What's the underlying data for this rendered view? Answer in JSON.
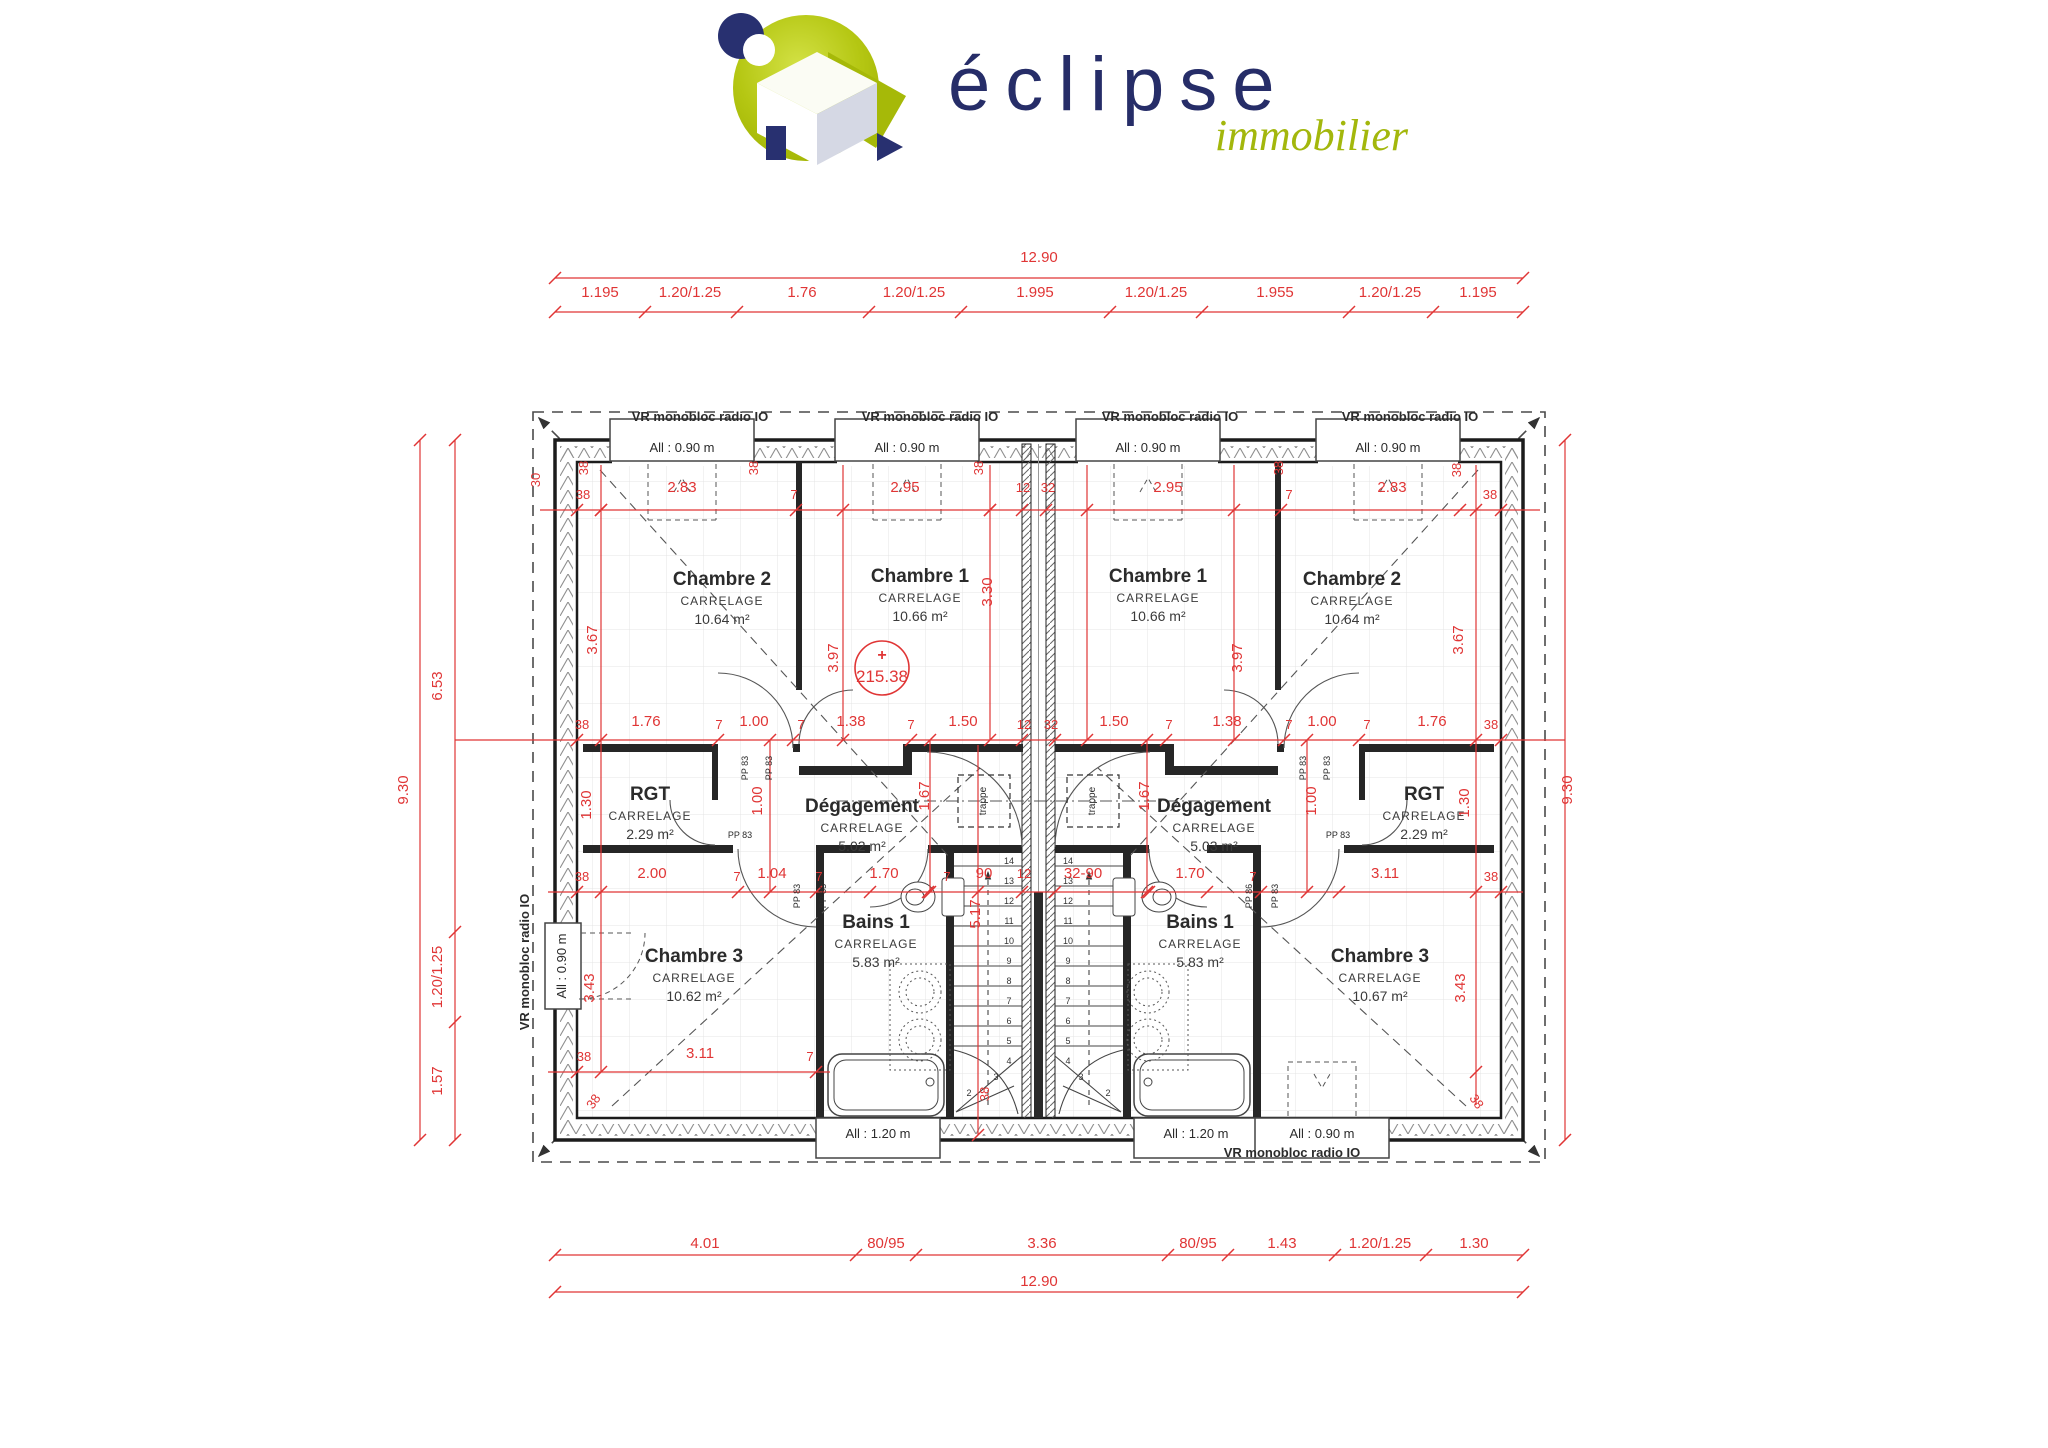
{
  "logo": {
    "brand": "éclipse",
    "tagline": "immobilier"
  },
  "colors": {
    "dim_red": "#e03535",
    "wall": "#1c1c1c",
    "logo_navy": "#283070",
    "logo_green": "#b5c713",
    "tile": "#e4e4e4"
  },
  "plan": {
    "rooms": [
      {
        "name": "Chambre 2",
        "finish": "CARRELAGE",
        "area": "10.64 m²",
        "x": 722,
        "y": 585
      },
      {
        "name": "Chambre 1",
        "finish": "CARRELAGE",
        "area": "10.66 m²",
        "x": 920,
        "y": 582
      },
      {
        "name": "RGT",
        "finish": "CARRELAGE",
        "area": "2.29 m²",
        "x": 650,
        "y": 800
      },
      {
        "name": "Dégagement",
        "finish": "CARRELAGE",
        "area": "5.02 m²",
        "x": 862,
        "y": 812
      },
      {
        "name": "Chambre 3",
        "finish": "CARRELAGE",
        "area": "10.62 m²",
        "x": 694,
        "y": 962
      },
      {
        "name": "Bains 1",
        "finish": "CARRELAGE",
        "area": "5.83 m²",
        "x": 876,
        "y": 928
      },
      {
        "name": "Chambre 1",
        "finish": "CARRELAGE",
        "area": "10.66 m²",
        "x": 1158,
        "y": 582
      },
      {
        "name": "Chambre 2",
        "finish": "CARRELAGE",
        "area": "10.64 m²",
        "x": 1352,
        "y": 585
      },
      {
        "name": "Dégagement",
        "finish": "CARRELAGE",
        "area": "5.03 m²",
        "x": 1214,
        "y": 812
      },
      {
        "name": "RGT",
        "finish": "CARRELAGE",
        "area": "2.29 m²",
        "x": 1424,
        "y": 800
      },
      {
        "name": "Bains 1",
        "finish": "CARRELAGE",
        "area": "5.83 m²",
        "x": 1200,
        "y": 928
      },
      {
        "name": "Chambre 3",
        "finish": "CARRELAGE",
        "area": "10.67 m²",
        "x": 1380,
        "y": 962
      }
    ],
    "labels": [
      {
        "t": "VR monobloc radio IO",
        "x": 700,
        "y": 421,
        "b": 1,
        "n": "shutter-label"
      },
      {
        "t": "VR monobloc radio IO",
        "x": 930,
        "y": 421,
        "b": 1,
        "n": "shutter-label"
      },
      {
        "t": "VR monobloc radio IO",
        "x": 1170,
        "y": 421,
        "b": 1,
        "n": "shutter-label"
      },
      {
        "t": "VR monobloc radio IO",
        "x": 1410,
        "y": 421,
        "b": 1,
        "n": "shutter-label"
      },
      {
        "t": "VR monobloc radio IO",
        "x": 529,
        "y": 962,
        "r": -90,
        "b": 1,
        "n": "shutter-label"
      },
      {
        "t": "VR monobloc radio IO",
        "x": 1292,
        "y": 1157,
        "b": 1,
        "n": "shutter-label"
      },
      {
        "t": "All : 0.90 m",
        "x": 682,
        "y": 452,
        "n": "window-height-label"
      },
      {
        "t": "All : 0.90 m",
        "x": 907,
        "y": 452,
        "n": "window-height-label"
      },
      {
        "t": "All : 0.90 m",
        "x": 1148,
        "y": 452,
        "n": "window-height-label"
      },
      {
        "t": "All : 0.90 m",
        "x": 1388,
        "y": 452,
        "n": "window-height-label"
      },
      {
        "t": "All : 0.90 m",
        "x": 566,
        "y": 966,
        "r": -90,
        "n": "window-height-label"
      },
      {
        "t": "All : 1.20 m",
        "x": 878,
        "y": 1138,
        "n": "window-height-label"
      },
      {
        "t": "All : 1.20 m",
        "x": 1196,
        "y": 1138,
        "n": "window-height-label"
      },
      {
        "t": "All : 0.90 m",
        "x": 1322,
        "y": 1138,
        "n": "window-height-label"
      },
      {
        "t": "trappe",
        "x": 986,
        "y": 801,
        "r": -90,
        "s": 10,
        "n": "hatch-label"
      },
      {
        "t": "trappe",
        "x": 1095,
        "y": 801,
        "r": -90,
        "s": 10,
        "n": "hatch-label"
      },
      {
        "t": "PP 83",
        "x": 748,
        "y": 768,
        "r": -90,
        "s": 9,
        "n": "door-label"
      },
      {
        "t": "PP 83",
        "x": 772,
        "y": 768,
        "r": -90,
        "s": 9,
        "n": "door-label"
      },
      {
        "t": "PP 83",
        "x": 1306,
        "y": 768,
        "r": -90,
        "s": 9,
        "n": "door-label"
      },
      {
        "t": "PP 83",
        "x": 1330,
        "y": 768,
        "r": -90,
        "s": 9,
        "n": "door-label"
      },
      {
        "t": "PP 83",
        "x": 740,
        "y": 838,
        "s": 9,
        "n": "door-label"
      },
      {
        "t": "PP 83",
        "x": 1338,
        "y": 838,
        "s": 9,
        "n": "door-label"
      },
      {
        "t": "PP 83",
        "x": 800,
        "y": 896,
        "r": -90,
        "s": 9,
        "n": "door-label"
      },
      {
        "t": "PP 83",
        "x": 826,
        "y": 896,
        "r": -90,
        "s": 9,
        "n": "door-label"
      },
      {
        "t": "PP 86",
        "x": 1252,
        "y": 896,
        "r": -90,
        "s": 9,
        "n": "door-label"
      },
      {
        "t": "PP 83",
        "x": 1278,
        "y": 896,
        "r": -90,
        "s": 9,
        "n": "door-label"
      }
    ],
    "dims": [
      {
        "t": "12.90",
        "x": 1039,
        "y": 262
      },
      {
        "t": "1.195",
        "x": 600,
        "y": 297
      },
      {
        "t": "1.20/1.25",
        "x": 690,
        "y": 297
      },
      {
        "t": "1.76",
        "x": 802,
        "y": 297
      },
      {
        "t": "1.20/1.25",
        "x": 914,
        "y": 297
      },
      {
        "t": "1.995",
        "x": 1035,
        "y": 297
      },
      {
        "t": "1.20/1.25",
        "x": 1156,
        "y": 297
      },
      {
        "t": "1.955",
        "x": 1275,
        "y": 297
      },
      {
        "t": "1.20/1.25",
        "x": 1390,
        "y": 297
      },
      {
        "t": "1.195",
        "x": 1478,
        "y": 297
      },
      {
        "t": "4.01",
        "x": 705,
        "y": 1248
      },
      {
        "t": "80/95",
        "x": 886,
        "y": 1248
      },
      {
        "t": "3.36",
        "x": 1042,
        "y": 1248
      },
      {
        "t": "80/95",
        "x": 1198,
        "y": 1248
      },
      {
        "t": "1.43",
        "x": 1282,
        "y": 1248
      },
      {
        "t": "1.20/1.25",
        "x": 1380,
        "y": 1248
      },
      {
        "t": "1.30",
        "x": 1474,
        "y": 1248
      },
      {
        "t": "12.90",
        "x": 1039,
        "y": 1286
      },
      {
        "t": "9.30",
        "x": 408,
        "y": 790,
        "r": -90
      },
      {
        "t": "6.53",
        "x": 442,
        "y": 686,
        "r": -90
      },
      {
        "t": "1.20/1.25",
        "x": 442,
        "y": 977,
        "r": -90
      },
      {
        "t": "1.57",
        "x": 442,
        "y": 1081,
        "r": -90
      },
      {
        "t": "9.30",
        "x": 1572,
        "y": 790,
        "r": -90
      },
      {
        "t": "30",
        "x": 540,
        "y": 480,
        "r": -90,
        "s": 13
      },
      {
        "t": "38",
        "x": 588,
        "y": 468,
        "r": -90,
        "s": 13
      },
      {
        "t": "38",
        "x": 583,
        "y": 499,
        "s": 13
      },
      {
        "t": "2.83",
        "x": 682,
        "y": 492
      },
      {
        "t": "38",
        "x": 758,
        "y": 468,
        "r": -90,
        "s": 13
      },
      {
        "t": "7",
        "x": 794,
        "y": 499,
        "s": 13
      },
      {
        "t": "2.95",
        "x": 905,
        "y": 492
      },
      {
        "t": "38",
        "x": 983,
        "y": 468,
        "r": -90,
        "s": 13
      },
      {
        "t": "12",
        "x": 1023,
        "y": 492,
        "s": 13
      },
      {
        "t": "32",
        "x": 1048,
        "y": 492,
        "s": 13
      },
      {
        "t": "2.95",
        "x": 1168,
        "y": 492
      },
      {
        "t": "38",
        "x": 1283,
        "y": 468,
        "r": -90,
        "s": 13
      },
      {
        "t": "7",
        "x": 1289,
        "y": 499,
        "s": 13
      },
      {
        "t": "2.83",
        "x": 1392,
        "y": 492
      },
      {
        "t": "38",
        "x": 1461,
        "y": 470,
        "r": -90,
        "s": 13
      },
      {
        "t": "38",
        "x": 1490,
        "y": 499,
        "s": 13
      },
      {
        "t": "3.67",
        "x": 597,
        "y": 640,
        "r": -90
      },
      {
        "t": "3.97",
        "x": 838,
        "y": 658,
        "r": -90
      },
      {
        "t": "3.30",
        "x": 992,
        "y": 592,
        "r": -90
      },
      {
        "t": "3.97",
        "x": 1242,
        "y": 658,
        "r": -90
      },
      {
        "t": "3.67",
        "x": 1463,
        "y": 640,
        "r": -90
      },
      {
        "t": "38",
        "x": 582,
        "y": 729,
        "s": 13
      },
      {
        "t": "1.76",
        "x": 646,
        "y": 726
      },
      {
        "t": "7",
        "x": 719,
        "y": 729,
        "s": 13
      },
      {
        "t": "1.00",
        "x": 754,
        "y": 726
      },
      {
        "t": "7",
        "x": 801,
        "y": 729,
        "s": 13
      },
      {
        "t": "1.38",
        "x": 851,
        "y": 726
      },
      {
        "t": "7",
        "x": 911,
        "y": 729,
        "s": 13
      },
      {
        "t": "1.50",
        "x": 963,
        "y": 726
      },
      {
        "t": "12",
        "x": 1024,
        "y": 729,
        "s": 13
      },
      {
        "t": "32",
        "x": 1051,
        "y": 729,
        "s": 13
      },
      {
        "t": "1.50",
        "x": 1114,
        "y": 726
      },
      {
        "t": "7",
        "x": 1169,
        "y": 729,
        "s": 13
      },
      {
        "t": "1.38",
        "x": 1227,
        "y": 726
      },
      {
        "t": "7",
        "x": 1289,
        "y": 729,
        "s": 13
      },
      {
        "t": "1.00",
        "x": 1322,
        "y": 726
      },
      {
        "t": "7",
        "x": 1367,
        "y": 729,
        "s": 13
      },
      {
        "t": "1.76",
        "x": 1432,
        "y": 726
      },
      {
        "t": "38",
        "x": 1491,
        "y": 729,
        "s": 13
      },
      {
        "t": "1.30",
        "x": 591,
        "y": 805,
        "r": -90
      },
      {
        "t": "1.00",
        "x": 762,
        "y": 801,
        "r": -90
      },
      {
        "t": "1.67",
        "x": 929,
        "y": 796,
        "r": -90
      },
      {
        "t": "1.67",
        "x": 1149,
        "y": 796,
        "r": -90
      },
      {
        "t": "1.00",
        "x": 1316,
        "y": 801,
        "r": -90
      },
      {
        "t": "1.30",
        "x": 1469,
        "y": 803,
        "r": -90
      },
      {
        "t": "38",
        "x": 582,
        "y": 881,
        "s": 13
      },
      {
        "t": "2.00",
        "x": 652,
        "y": 878
      },
      {
        "t": "7",
        "x": 737,
        "y": 881,
        "s": 13
      },
      {
        "t": "1.04",
        "x": 772,
        "y": 878
      },
      {
        "t": "7",
        "x": 819,
        "y": 881,
        "s": 13
      },
      {
        "t": "1.70",
        "x": 884,
        "y": 878
      },
      {
        "t": "7",
        "x": 947,
        "y": 881,
        "s": 13
      },
      {
        "t": "90",
        "x": 984,
        "y": 878
      },
      {
        "t": "12",
        "x": 1024,
        "y": 878,
        "s": 13
      },
      {
        "t": "32-90",
        "x": 1083,
        "y": 878
      },
      {
        "t": "1.70",
        "x": 1190,
        "y": 878
      },
      {
        "t": "7",
        "x": 1253,
        "y": 881,
        "s": 13
      },
      {
        "t": "3.11",
        "x": 1385,
        "y": 878
      },
      {
        "t": "38",
        "x": 1491,
        "y": 881,
        "s": 13
      },
      {
        "t": "5.17",
        "x": 980,
        "y": 914,
        "r": -90
      },
      {
        "t": "3.43",
        "x": 594,
        "y": 988,
        "r": -90
      },
      {
        "t": "3.43",
        "x": 1465,
        "y": 988,
        "r": -90
      },
      {
        "t": "38",
        "x": 989,
        "y": 1094,
        "r": -90,
        "s": 13
      },
      {
        "t": "38",
        "x": 584,
        "y": 1061,
        "s": 13
      },
      {
        "t": "3.11",
        "x": 700,
        "y": 1058
      },
      {
        "t": "7",
        "x": 810,
        "y": 1061,
        "s": 13
      },
      {
        "t": "38",
        "x": 597,
        "y": 1104,
        "r": -55,
        "s": 13
      },
      {
        "t": "38",
        "x": 1473,
        "y": 1104,
        "r": 55,
        "s": 13
      }
    ],
    "stairs": {
      "numbers": [
        "14",
        "13",
        "12",
        "11",
        "10",
        "9",
        "8",
        "7",
        "6",
        "5",
        "4"
      ],
      "left_x": 1009,
      "right_x": 1068,
      "top_y": 864,
      "step": 20,
      "left_winders": [
        {
          "t": "3",
          "x": 996,
          "y": 1080
        },
        {
          "t": "2",
          "x": 969,
          "y": 1096
        }
      ],
      "right_winders": [
        {
          "t": "3",
          "x": 1081,
          "y": 1080
        },
        {
          "t": "2",
          "x": 1108,
          "y": 1096
        }
      ]
    },
    "survey_marker": {
      "plus": "+",
      "value": "215.38",
      "x": 882,
      "y": 668
    }
  }
}
